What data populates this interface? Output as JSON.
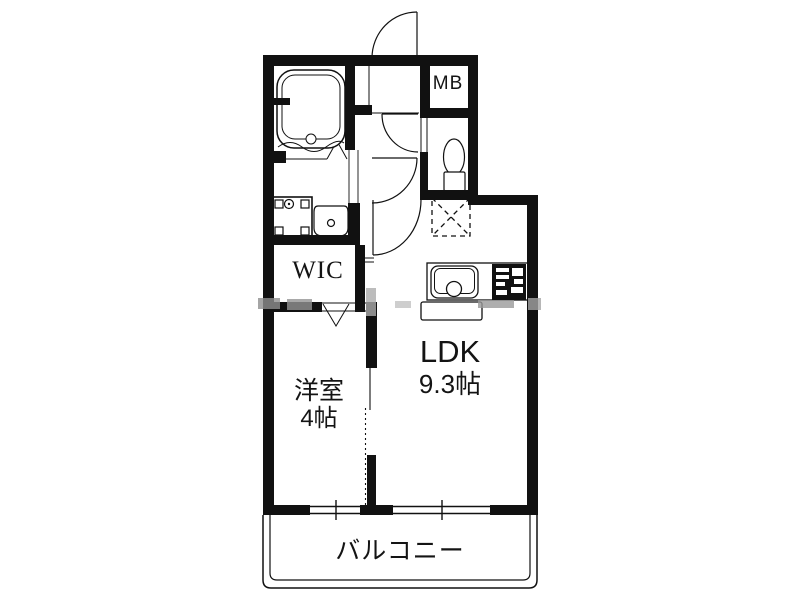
{
  "rooms": {
    "mb": {
      "label": "MB"
    },
    "wic": {
      "label": "WIC"
    },
    "western_room": {
      "label": "洋室",
      "size": "4帖"
    },
    "ldk": {
      "label": "LDK",
      "size": "9.3帖"
    },
    "balcony": {
      "label": "バルコニー"
    }
  },
  "fixtures": {
    "bathtub": "bathtub-icon",
    "toilet": "toilet-icon",
    "washbasin": "washbasin-icon",
    "washing_machine_pan": "washing-machine-pan-icon",
    "kitchen_sink": "kitchen-sink-icon",
    "stove": "stove-icon",
    "refrigerator_space": "refrigerator-space-icon"
  },
  "colors": {
    "line": "#111111",
    "background": "#ffffff",
    "watermark": "#9a9a9a"
  }
}
